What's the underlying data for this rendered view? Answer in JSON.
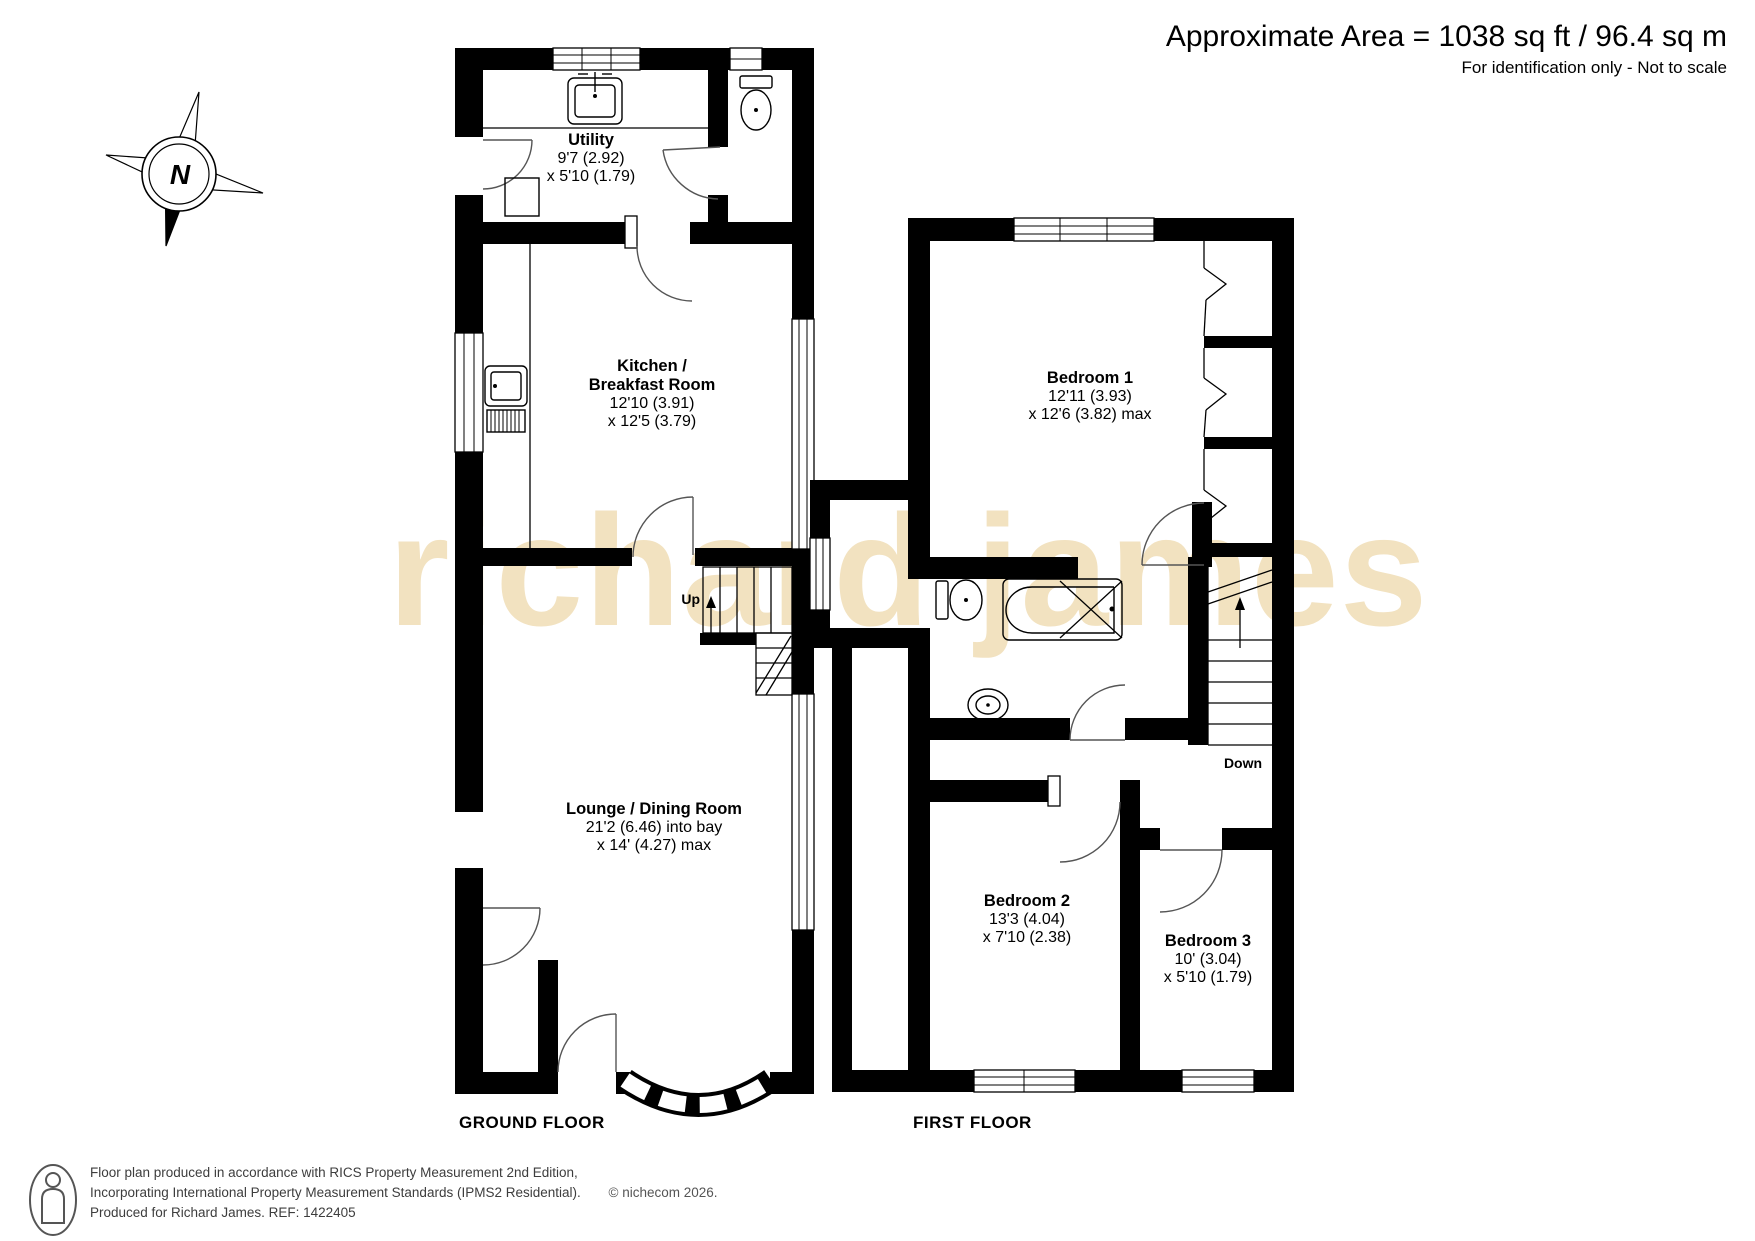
{
  "header": {
    "area_line": "Approximate Area = 1038 sq ft / 96.4 sq m",
    "note_line": "For identification only - Not to scale"
  },
  "compass": {
    "north_label": "N"
  },
  "watermark": "richard james",
  "rooms": {
    "utility": {
      "name": "Utility",
      "dim1": "9'7 (2.92)",
      "dim2": "x 5'10 (1.79)"
    },
    "kitchen": {
      "name_line1": "Kitchen /",
      "name_line2": "Breakfast Room",
      "dim1": "12'10 (3.91)",
      "dim2": "x 12'5 (3.79)"
    },
    "lounge": {
      "name": "Lounge / Dining Room",
      "dim1": "21'2 (6.46) into bay",
      "dim2": "x 14' (4.27) max"
    },
    "bedroom1": {
      "name": "Bedroom 1",
      "dim1": "12'11 (3.93)",
      "dim2": "x 12'6 (3.82) max"
    },
    "bedroom2": {
      "name": "Bedroom 2",
      "dim1": "13'3 (4.04)",
      "dim2": "x 7'10 (2.38)"
    },
    "bedroom3": {
      "name": "Bedroom 3",
      "dim1": "10' (3.04)",
      "dim2": "x 5'10 (1.79)"
    }
  },
  "stairs": {
    "up_label": "Up",
    "down_label": "Down"
  },
  "floor_labels": {
    "ground": "GROUND FLOOR",
    "first": "FIRST FLOOR"
  },
  "footer": {
    "line1": "Floor plan produced in accordance with RICS Property Measurement 2nd Edition,",
    "line2": "Incorporating International Property Measurement Standards (IPMS2 Residential).",
    "credit": "© nichecom 2026.",
    "line3": "Produced for Richard James.   REF:  1422405"
  }
}
